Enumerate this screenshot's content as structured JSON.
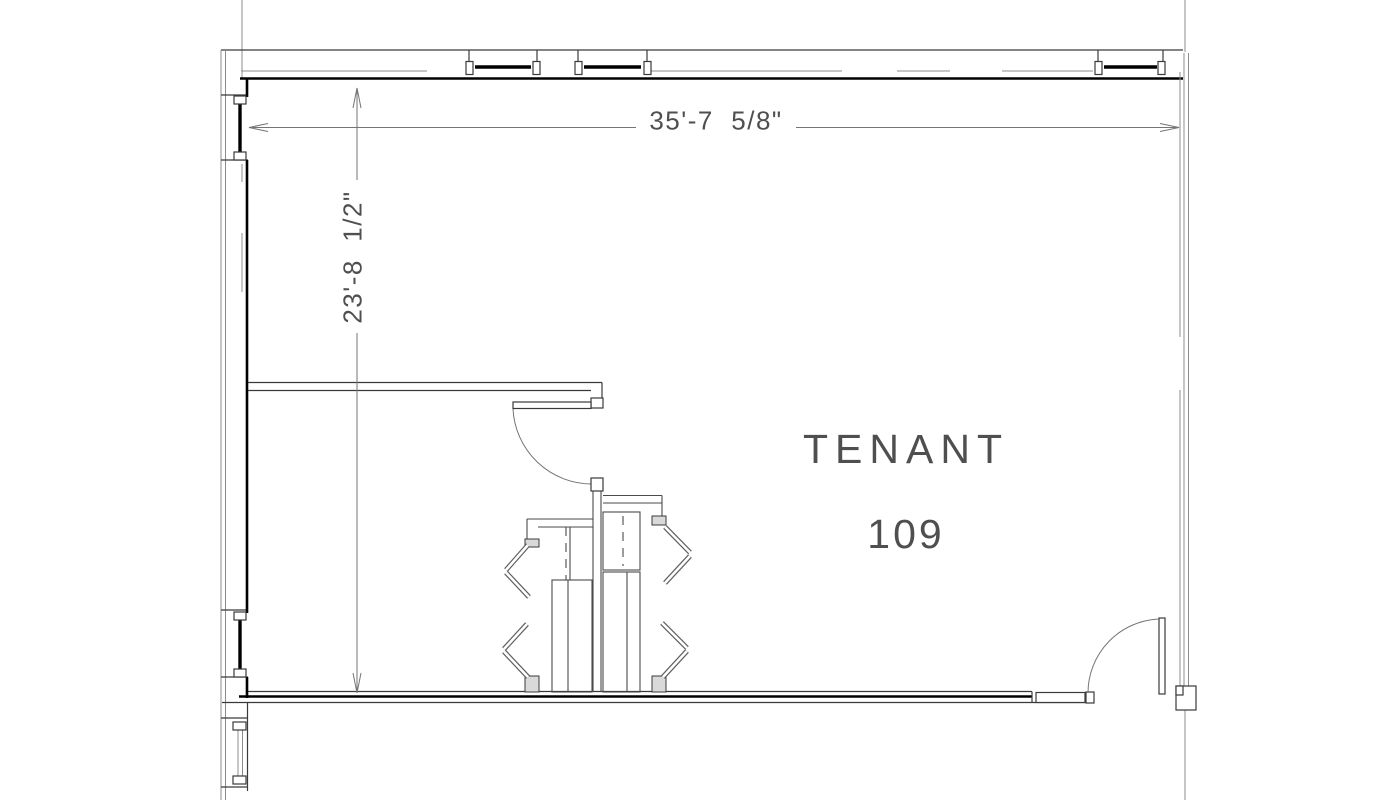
{
  "drawing": {
    "room_label": {
      "line1": "TENANT",
      "line2": "109"
    },
    "dimensions": {
      "width": "35'-7  5/8\"",
      "height": "23'-8  1/2\""
    },
    "colors": {
      "background": "#ffffff",
      "wall_heavy": "#000000",
      "wall_medium": "#3a3a3a",
      "line_light": "#8c8c8c",
      "dimension_line": "#757575",
      "text": "#4f4f4f"
    }
  }
}
